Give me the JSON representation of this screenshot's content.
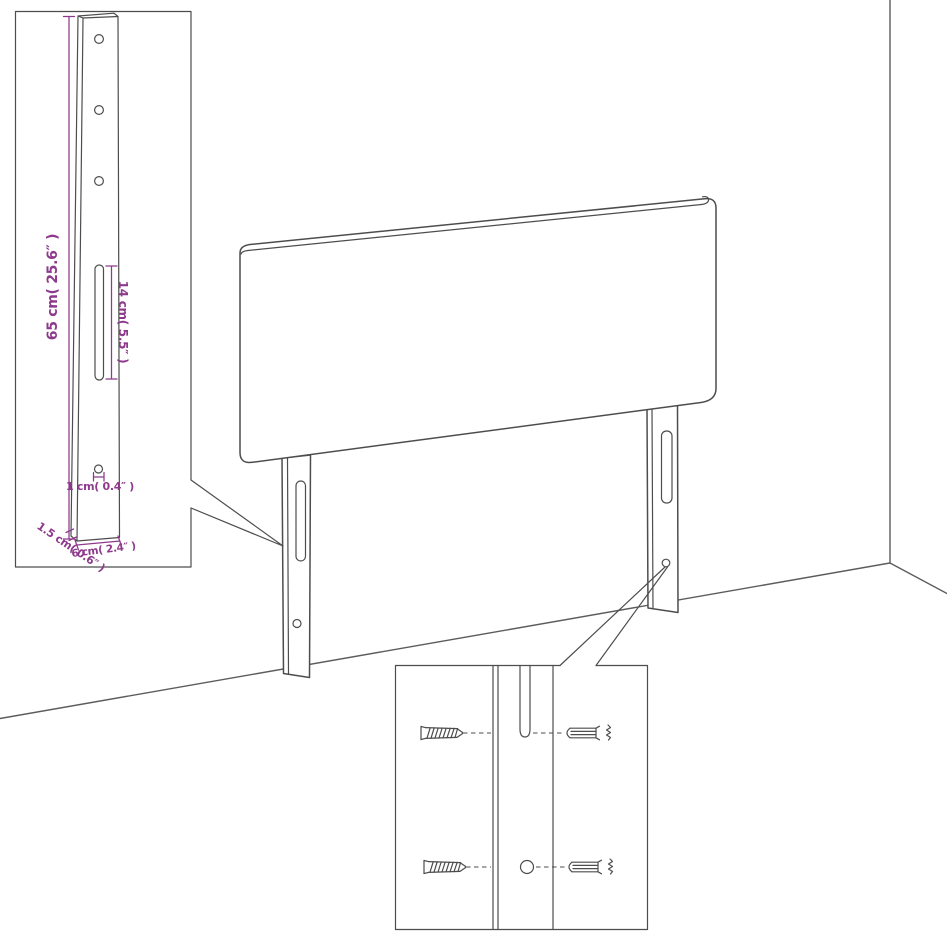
{
  "diagram": {
    "type": "furniture-assembly-diagram",
    "colors": {
      "background": "#ffffff",
      "line": "#4d4d4d",
      "dimension": "#8e3a8c"
    },
    "leg_detail_inset": {
      "labels": {
        "overall_height": "65 cm( 25.6″ )",
        "slot_length": "14 cm( 5.5″ )",
        "hole_diameter": "1 cm( 0.4″ )",
        "side_thickness": "1.5 cm( 0.6″ )",
        "leg_width": "6 cm( 2.4″ )"
      }
    }
  }
}
